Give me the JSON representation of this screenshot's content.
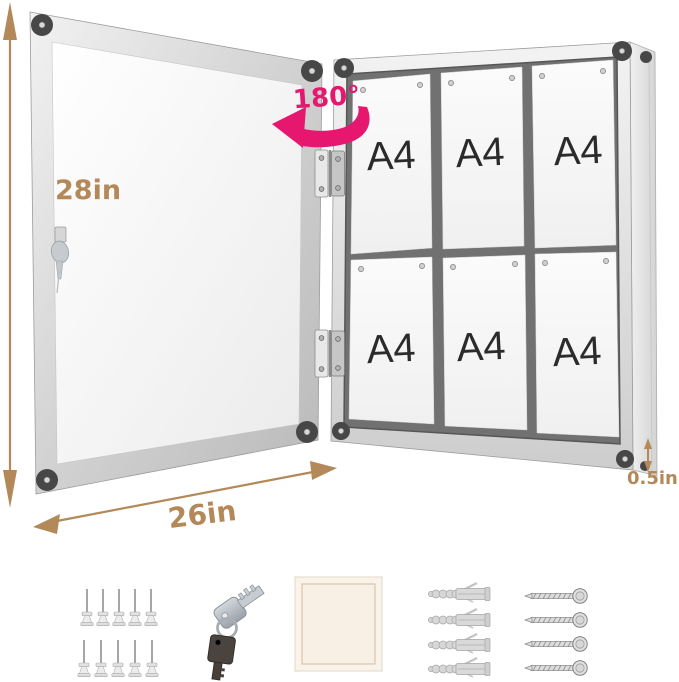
{
  "annotations": {
    "height": "28in",
    "width": "26in",
    "depth": "0.5in",
    "rotation": "180°"
  },
  "display_board": {
    "layout": {
      "rows": 2,
      "columns": 3
    },
    "papers": [
      {
        "label": "A4"
      },
      {
        "label": "A4"
      },
      {
        "label": "A4"
      },
      {
        "label": "A4"
      },
      {
        "label": "A4"
      },
      {
        "label": "A4"
      }
    ]
  },
  "accessories": [
    {
      "name": "push-pins",
      "count": 10
    },
    {
      "name": "keys",
      "count": 2
    },
    {
      "name": "adhesive-pad",
      "count": 1
    },
    {
      "name": "wall-anchors",
      "count": 4
    },
    {
      "name": "screws",
      "count": 4
    }
  ],
  "colors": {
    "dimension_tan": "#b3895a",
    "rotation_pink": "#e5176e",
    "frame_silver": "#d7d7d7",
    "corner_dark": "#474747",
    "board_interior": "#717171",
    "paper_white": "#f8f8f8"
  }
}
